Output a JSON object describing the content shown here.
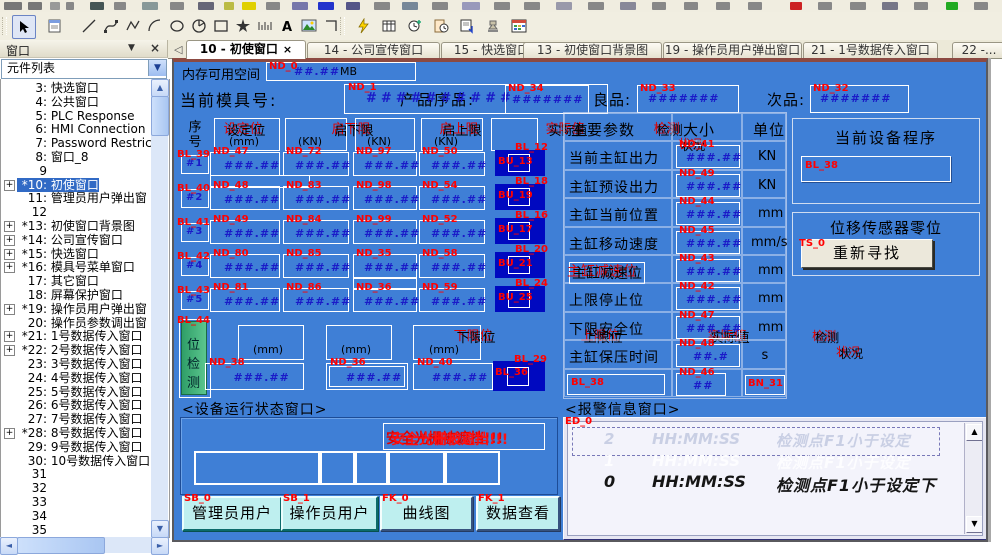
{
  "toolbar": {
    "tools": [
      "select-tool",
      "properties-tool",
      "line-tool",
      "bezier-tool",
      "polyline-tool",
      "arc-tool",
      "ellipse-tool",
      "pie-tool",
      "rectangle-tool",
      "star-tool",
      "scale-tool",
      "text-tool",
      "picture-tool",
      "corner-tool"
    ],
    "actions": [
      "macro-tool",
      "database-tool",
      "scheduler-tool",
      "clipboard-clock-tool",
      "report-tool",
      "stamp-tool",
      "calendar-grid-tool"
    ]
  },
  "panel": {
    "title": "窗口"
  },
  "combo": {
    "value": "元件列表"
  },
  "tabs": [
    {
      "label": "10 - 初使窗口",
      "close": "×",
      "active": true
    },
    {
      "label": "14 - 公司宣传窗口",
      "active": false
    },
    {
      "label": "15 - 快选窗口",
      "active": false
    },
    {
      "label": "13 - 初使窗口背景图",
      "active": false
    },
    {
      "label": "19 - 操作员用户弹出窗口",
      "active": false
    },
    {
      "label": "21 - 1号数据传入窗口",
      "active": false
    },
    {
      "label": "22 -...",
      "active": false
    }
  ],
  "sidebar": {
    "items": [
      {
        "num": "3",
        "name": "快选窗口"
      },
      {
        "num": "4",
        "name": "公共窗口"
      },
      {
        "num": "5",
        "name": "PLC Response"
      },
      {
        "num": "6",
        "name": "HMI Connection"
      },
      {
        "num": "7",
        "name": "Password Restrict"
      },
      {
        "num": "8",
        "name": "窗口_8"
      },
      {
        "num": "9",
        "name": ""
      },
      {
        "num": "*10",
        "name": "初使窗口",
        "expand": true,
        "selected": true
      },
      {
        "num": "11",
        "name": "管理员用户弹出窗"
      },
      {
        "num": "12",
        "name": ""
      },
      {
        "num": "*13",
        "name": "初使窗口背景图",
        "expand": true
      },
      {
        "num": "*14",
        "name": "公司宣传窗口",
        "expand": true
      },
      {
        "num": "*15",
        "name": "快选窗口",
        "expand": true
      },
      {
        "num": "*16",
        "name": "模具号菜单窗口",
        "expand": true
      },
      {
        "num": "17",
        "name": "其它窗口"
      },
      {
        "num": "18",
        "name": "屏幕保护窗口"
      },
      {
        "num": "*19",
        "name": "操作员用户弹出窗",
        "expand": true
      },
      {
        "num": "20",
        "name": "操作员参数调出窗"
      },
      {
        "num": "*21",
        "name": "1号数据传入窗口",
        "expand": true
      },
      {
        "num": "*22",
        "name": "2号数据传入窗口",
        "expand": true
      },
      {
        "num": "23",
        "name": "3号数据传入窗口"
      },
      {
        "num": "24",
        "name": "4号数据传入窗口"
      },
      {
        "num": "25",
        "name": "5号数据传入窗口"
      },
      {
        "num": "26",
        "name": "6号数据传入窗口"
      },
      {
        "num": "27",
        "name": "7号数据传入窗口"
      },
      {
        "num": "*28",
        "name": "8号数据传入窗口",
        "expand": true
      },
      {
        "num": "29",
        "name": "9号数据传入窗口"
      },
      {
        "num": "30",
        "name": "10号数据传入窗口"
      },
      {
        "num": "31",
        "name": ""
      },
      {
        "num": "32",
        "name": ""
      },
      {
        "num": "33",
        "name": ""
      },
      {
        "num": "34",
        "name": ""
      },
      {
        "num": "35",
        "name": ""
      },
      {
        "num": "36",
        "name": ""
      }
    ]
  },
  "canvas": {
    "memory": {
      "label": "内存可用空间",
      "id": "ND_0",
      "value": "##.##",
      "unit": "MB"
    },
    "mold": {
      "label": "当前模具号:",
      "id": "ND_1",
      "value": "##########"
    },
    "product": {
      "label": "产品序品:",
      "id": "ND_34",
      "value": "#######"
    },
    "good": {
      "label": "良品:",
      "id": "ND_33",
      "value": "#######"
    },
    "bad": {
      "label": "次品:",
      "id": "ND_32",
      "value": "#######"
    },
    "main_table": {
      "seq_header": [
        "序",
        "号"
      ],
      "headers": [
        {
          "title": "设定位",
          "unit": "(mm)"
        },
        {
          "title": "启下限",
          "unit": "(KN)"
        },
        {
          "title": "启上限",
          "unit": "(KN)"
        },
        {
          "title": "实际值",
          "unit": "(KN)"
        },
        {
          "title": "检测",
          "unit": "状况"
        }
      ],
      "rows": [
        {
          "seq": "#1",
          "seq_id": "BL_39",
          "ids": [
            "ND_47",
            "ND_72",
            "ND_97",
            "ND_50"
          ],
          "values": [
            "###.##",
            "###.##",
            "###.##",
            "###.##"
          ],
          "status_id": "BL_12",
          "status_inner_id": "BU_13"
        },
        {
          "seq": "#2",
          "seq_id": "BL_40",
          "ids": [
            "ND_48",
            "ND_83",
            "ND_98",
            "ND_54"
          ],
          "values": [
            "###.##",
            "###.##",
            "###.##",
            "###.##"
          ],
          "status_id": "BL_18",
          "status_inner_id": "BU_19"
        },
        {
          "seq": "#3",
          "seq_id": "BL_41",
          "ids": [
            "ND_49",
            "ND_84",
            "ND_99",
            "ND_52"
          ],
          "values": [
            "###.##",
            "###.##",
            "###.##",
            "###.##"
          ],
          "status_id": "BL_16",
          "status_inner_id": "BU_17"
        },
        {
          "seq": "#4",
          "seq_id": "BL_42",
          "ids": [
            "ND_80",
            "ND_85",
            "ND_35",
            "ND_58"
          ],
          "values": [
            "###.##",
            "###.##",
            "###.##",
            "###.##"
          ],
          "status_id": "BL_20",
          "status_inner_id": "BU_21"
        },
        {
          "seq": "#5",
          "seq_id": "BL_43",
          "ids": [
            "ND_81",
            "ND_86",
            "ND_36",
            "ND_59"
          ],
          "values": [
            "###.##",
            "###.##",
            "###.##",
            "###.##"
          ],
          "status_id": "BL_24",
          "status_inner_id": "BU_25"
        }
      ]
    },
    "zero_table": {
      "side_id": "BL_44",
      "side_chars": [
        "位",
        "检",
        "测"
      ],
      "headers": [
        {
          "title": "下限位",
          "unit": "(mm)"
        },
        {
          "title": "上限位",
          "unit": "(mm)"
        },
        {
          "title": "实际值",
          "unit": "(mm)"
        },
        {
          "title": "检测",
          "unit": "状况"
        }
      ],
      "values": [
        {
          "id": "ND_38",
          "v": "###.##"
        },
        {
          "id": "ND_36",
          "v": "###.##"
        },
        {
          "id": "ND_40",
          "v": "###.##"
        }
      ],
      "status_id": "BL_29",
      "status_inner_id": "BL_36"
    },
    "params": {
      "headers": [
        "主要参数",
        "大小",
        "单位"
      ],
      "rows": [
        {
          "name": "当前主缸出力",
          "id": "ND_41",
          "v": "###.##",
          "unit": "KN"
        },
        {
          "name": "主缸预设出力",
          "id": "ND_49",
          "v": "###.##",
          "unit": "KN"
        },
        {
          "name": "主缸当前位置",
          "id": "ND_44",
          "v": "###.##",
          "unit": "mm"
        },
        {
          "name": "主缸移动速度",
          "id": "ND_45",
          "v": "###.##",
          "unit": "mm/s"
        },
        {
          "name": "主缸减速位",
          "id": "ND_43",
          "v": "###.##",
          "unit": "mm",
          "boxed": true,
          "dup": true
        },
        {
          "name": "上限停止位",
          "id": "ND_42",
          "v": "###.##",
          "unit": "mm"
        },
        {
          "name": "下限安全位",
          "id": "ND_47",
          "v": "###.##",
          "unit": "mm"
        },
        {
          "name": "主缸保压时间",
          "id": "ND_48",
          "v": "##.#",
          "unit": "s"
        },
        {
          "name": "",
          "name_id": "BL_38",
          "id": "ND_46",
          "v": "##",
          "unit": "",
          "unit_id": "BN_31"
        }
      ]
    },
    "program": {
      "title": "当前设备程序",
      "field_id": "BL_38"
    },
    "sensor": {
      "title": "位移传感器零位",
      "button_id": "TS_0",
      "button_label": "重新寻找"
    },
    "status_window": {
      "title": "<设备运行状态窗口>",
      "alarm_text": "安全光栅被遮挡!!!"
    },
    "alarm_window": {
      "title": "<报警信息窗口>",
      "id": "ED_0",
      "rows": [
        {
          "n": "2",
          "t": "HH:MM:SS",
          "m": "检测点F1小于设定"
        },
        {
          "n": "1",
          "t": "HH:MM:SS",
          "m": "检测点F1小于设定"
        },
        {
          "n": "0",
          "t": "HH:MM:SS",
          "m": "检测点F1小于设定下"
        }
      ]
    },
    "buttons": [
      {
        "id": "SB_0",
        "label": "管理员用户"
      },
      {
        "id": "SB_1",
        "label": "操作员用户"
      },
      {
        "id": "FK_0",
        "label": "曲线图"
      },
      {
        "id": "FK_1",
        "label": "数据查看"
      }
    ]
  }
}
